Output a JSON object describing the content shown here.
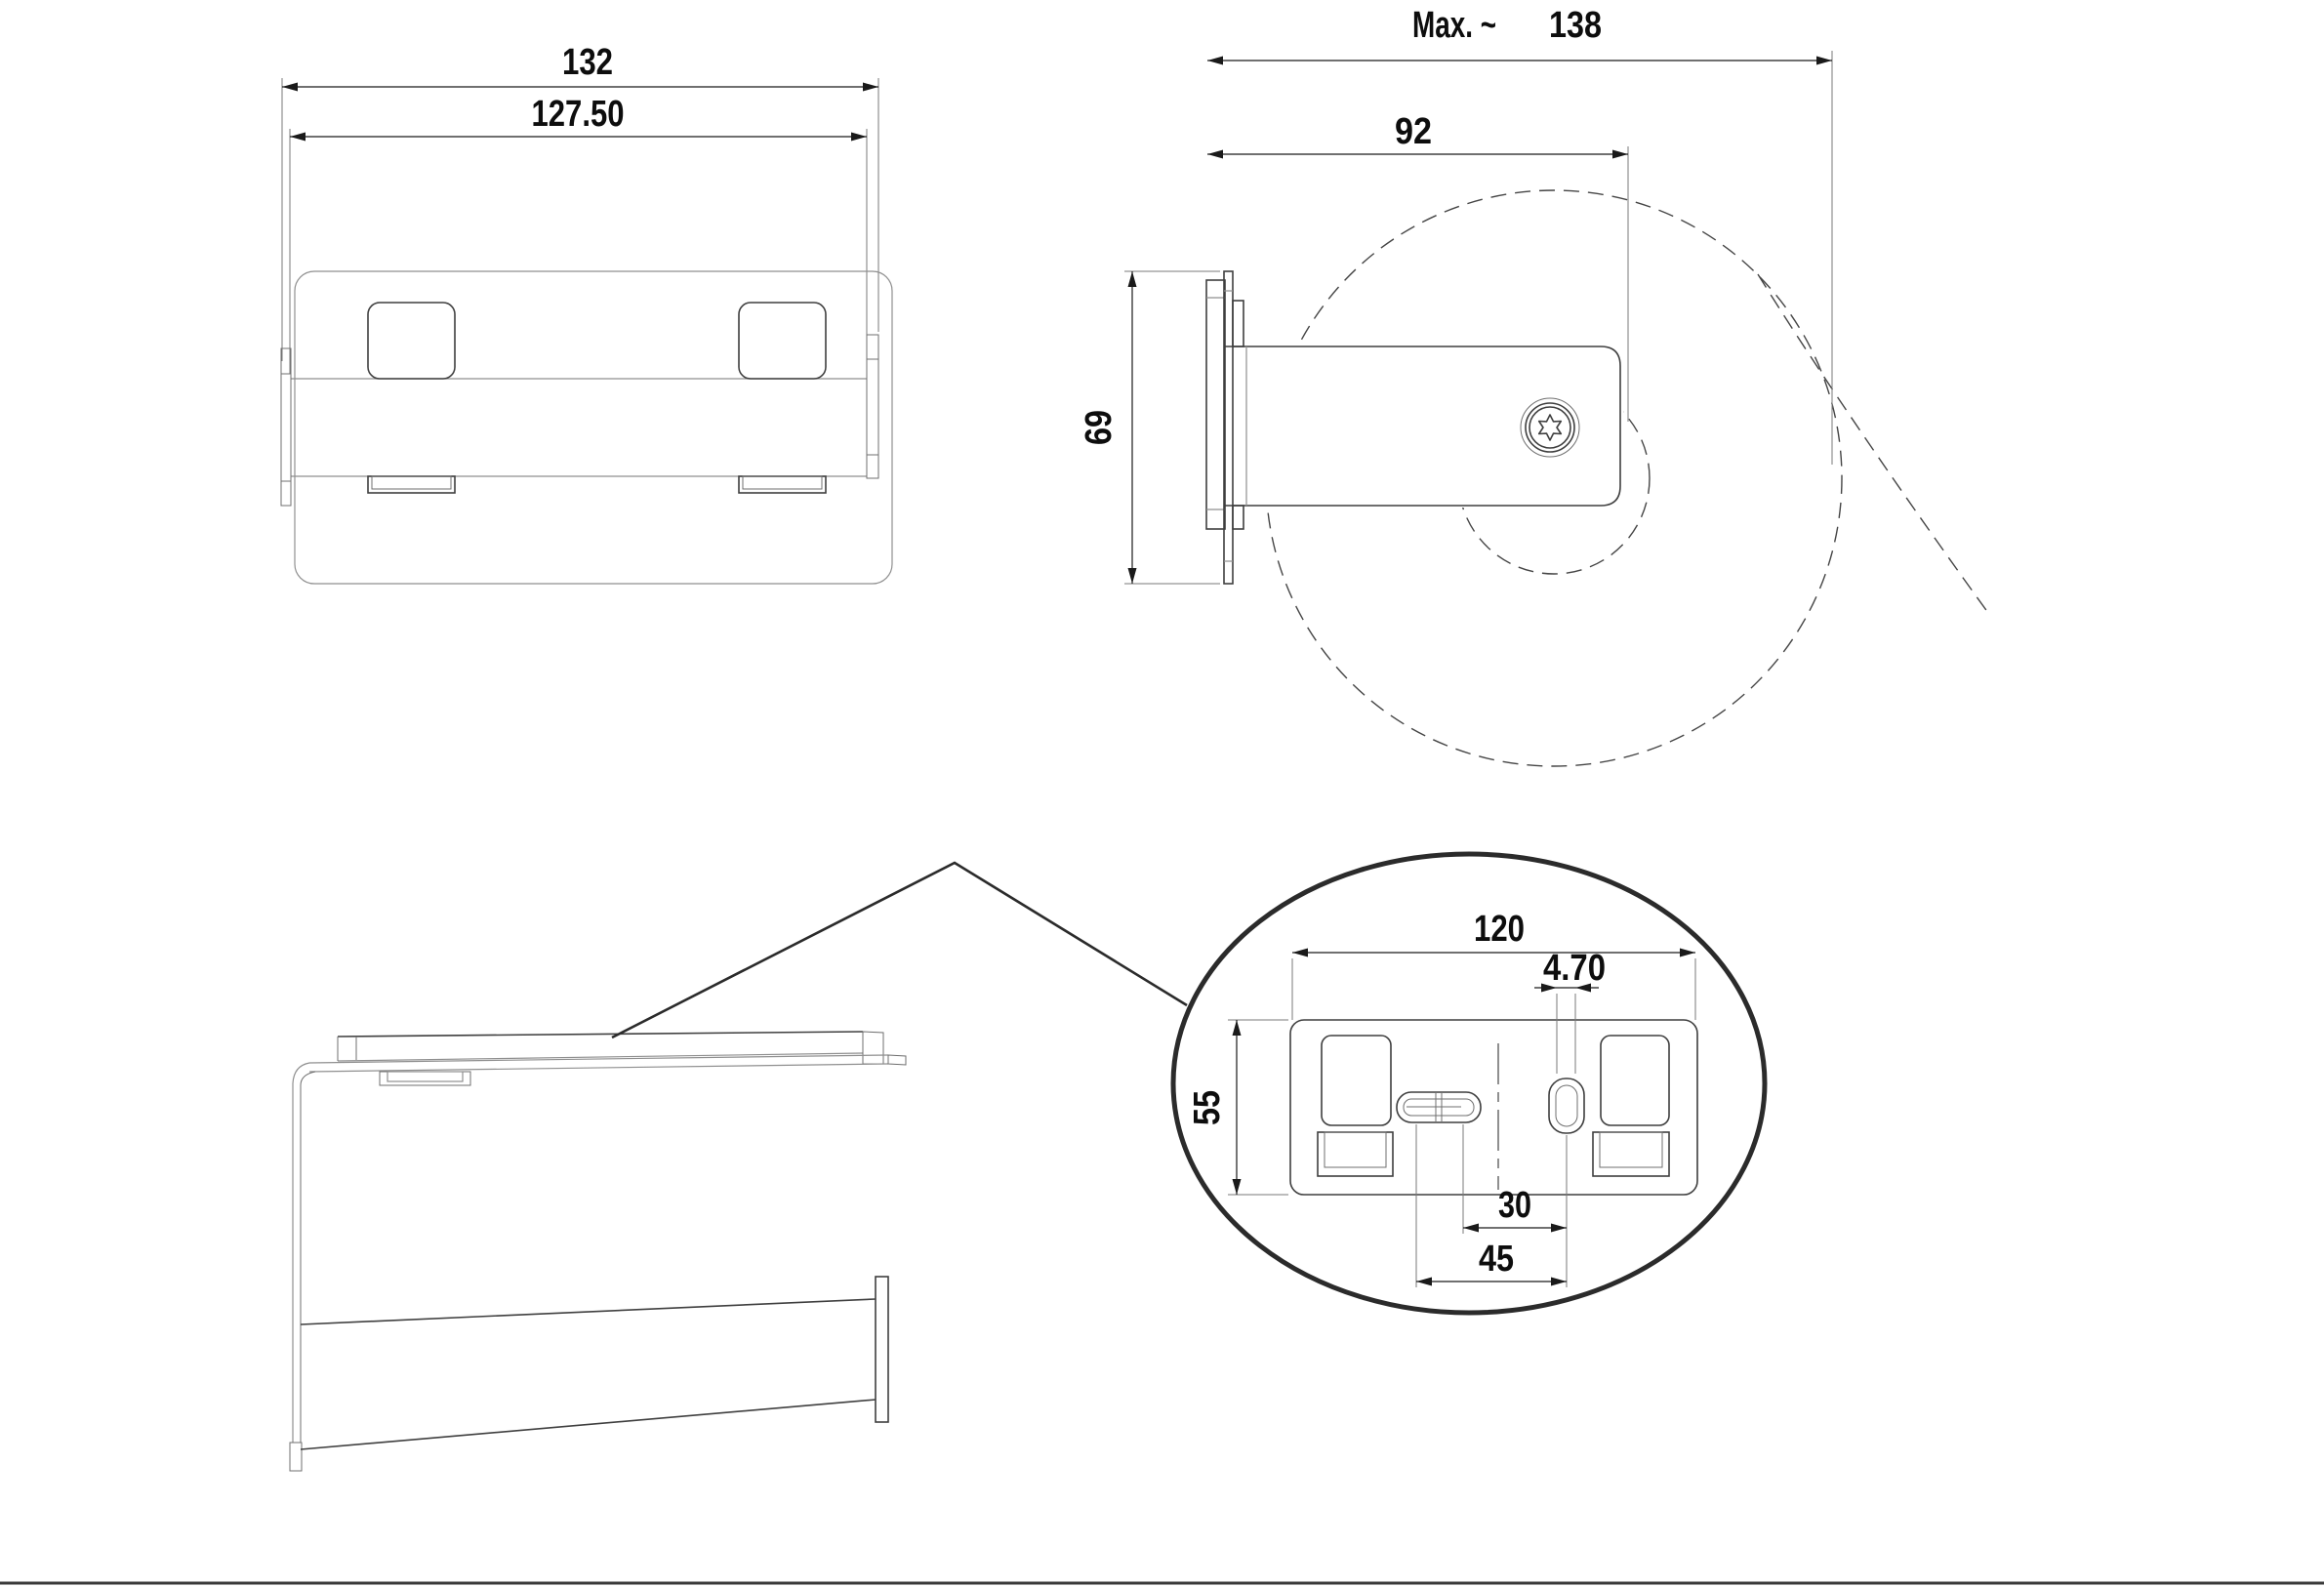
{
  "drawing": {
    "type": "technical-drawing",
    "subject": "wall-mounted toilet paper holder",
    "colors": {
      "background": "#ffffff",
      "main_line": "#3f3f3f",
      "dimension_line": "#1a1a1a",
      "light_line": "#8f8f8f",
      "text": "#0d0d0d"
    },
    "front_view": {
      "dims": {
        "overall_width": "132",
        "bar_width": "127.50"
      }
    },
    "side_view": {
      "dims": {
        "max_reach_prefix": "Max. ~",
        "max_reach_value": "138",
        "wall_to_axis": "92",
        "plate_height": "69"
      }
    },
    "detail_view": {
      "dims": {
        "plate_width": "120",
        "slot_width": "4.70",
        "plate_height": "55",
        "slot_spacing_inner": "30",
        "slot_spacing_outer": "45"
      }
    }
  }
}
